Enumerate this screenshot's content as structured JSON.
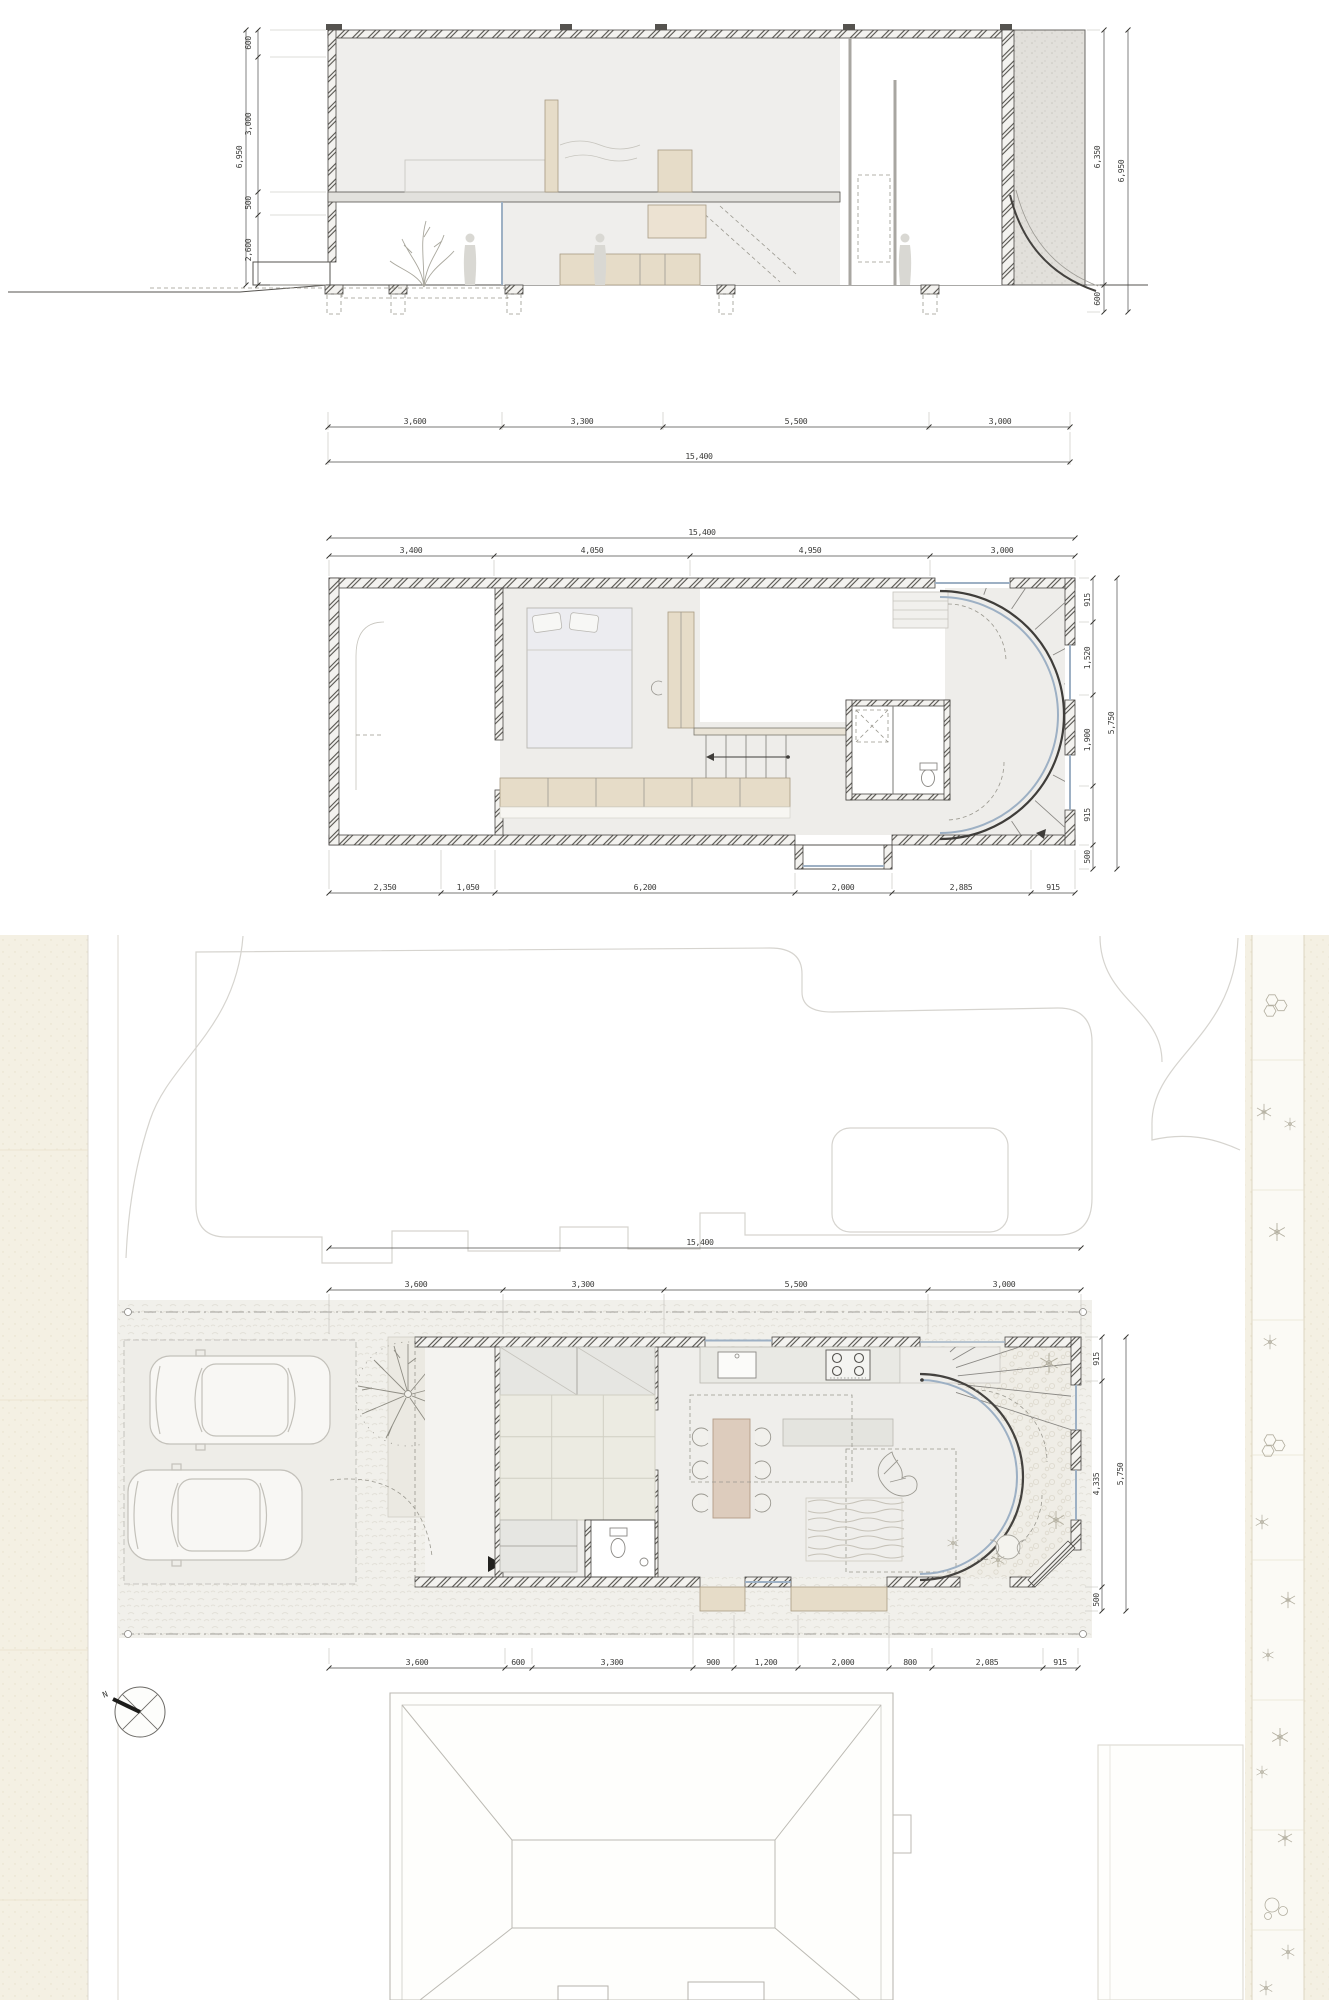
{
  "sheet": {
    "colors": {
      "paper": "#ffffff",
      "line": "#44423f",
      "wall_fill": "#f3f2ef",
      "wood_tan": "#e6dcc8",
      "street_beige": "#f4f0e3",
      "glass_blue": "#9db0c4"
    }
  },
  "section": {
    "left_chain": [
      "600",
      "3,000",
      "500",
      "2,600"
    ],
    "left_total": "6,950",
    "right_inner": "6,350",
    "right_lower": "600",
    "right_total": "6,950",
    "bottom_chain": [
      "3,600",
      "3,300",
      "5,500",
      "3,000"
    ],
    "bottom_total": "15,400"
  },
  "floor_plan": {
    "top_total": "15,400",
    "top_chain": [
      "3,400",
      "4,050",
      "4,950",
      "3,000"
    ],
    "right_chain": [
      "915",
      "1,520",
      "1,900",
      "915",
      "500"
    ],
    "right_total": "5,750",
    "bottom_chain": [
      "2,350",
      "1,050",
      "6,200",
      "2,000",
      "2,885",
      "915"
    ]
  },
  "site_plan": {
    "top_total": "15,400",
    "top_chain": [
      "3,600",
      "3,300",
      "5,500",
      "3,000"
    ],
    "right_chain": [
      "915",
      "4,335",
      "500"
    ],
    "right_total": "5,750",
    "bottom_chain": [
      "3,600",
      "600",
      "3,300",
      "900",
      "1,200",
      "2,000",
      "800",
      "2,085",
      "915"
    ],
    "compass_label": "N"
  }
}
